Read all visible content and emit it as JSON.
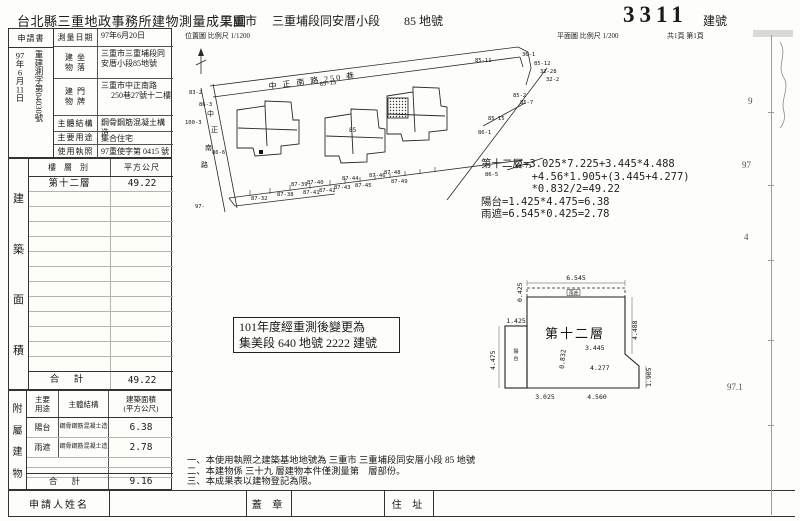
{
  "header": {
    "office_title": "台北縣三重地政事務所建物測量成果圖",
    "city": "三重市",
    "section": "三重埔段同安厝小段",
    "land_no": "85 地號",
    "building_no": "3311",
    "building_no_label": "建號",
    "location_map_caption": "位置圖 比例尺 1/1200",
    "floor_plan_caption": "平面圖 比例尺 1/200",
    "page_info": "共1頁 第1頁"
  },
  "info": {
    "application_label": "申請書",
    "file_date": "97年6月11日",
    "file_no_prefix": "重建測字第",
    "file_no_number": "04030",
    "file_no_suffix": "號",
    "rows": [
      {
        "label1": "測量日期",
        "label2": "",
        "value": "97年6月20日",
        "value2": ""
      },
      {
        "label1": "建 坐",
        "label2": "物 落",
        "value": "三重市三重埔段同安厝小段85地號",
        "value2": ""
      },
      {
        "label1": "建 門",
        "label2": "物 牌",
        "value": "三重市中正南路",
        "value2": "250巷27號十二樓"
      },
      {
        "label1": "主體結構",
        "label2": "",
        "value": "鋼骨鋼筋混凝土構造",
        "value2": ""
      },
      {
        "label1": "主要用途",
        "label2": "",
        "value": "集合住宅",
        "value2": ""
      },
      {
        "label1": "使用執照",
        "label2": "",
        "value": "97重使字第 0415 號",
        "value2": ""
      }
    ]
  },
  "area_table": {
    "side_chars": [
      "建",
      "築",
      "面",
      "積"
    ],
    "col_floor": "樓 層 別",
    "col_area": "平方公尺",
    "rows": [
      {
        "floor": "第十二層",
        "area": "49.22"
      }
    ],
    "empty_row_count": 12,
    "total_label": "合 計",
    "total_value": "49.22"
  },
  "annex_table": {
    "side_chars": [
      "附",
      "屬",
      "建",
      "物"
    ],
    "head_use_1": "主要",
    "head_use_2": "用途",
    "head_structure": "主體結構",
    "head_area_1": "建築面積",
    "head_area_2": "(平方公尺)",
    "rows": [
      {
        "use": "陽台",
        "structure": "鋼骨鋼筋混凝土造",
        "area": "6.38"
      },
      {
        "use": "雨遮",
        "structure": "鋼骨鋼筋混凝土造",
        "area": "2.78"
      }
    ],
    "total_label": "合 計",
    "total_value": "9.16"
  },
  "applicant_row": {
    "name_label": "申請人姓名",
    "seal_label": "蓋 章",
    "address_label": "住 址"
  },
  "stamp": {
    "line1": "101年度經重測後變更為",
    "line2": "集美段 640 地號 2222 建號"
  },
  "calc": {
    "lines": [
      "第十二層=3.025*7.225+3.445*4.488",
      "        +4.56*1.905+(3.445+4.277)",
      "        *0.832/2=49.22",
      "陽台=1.425*4.475=6.38",
      "雨遮=6.545*0.425=2.78"
    ]
  },
  "site_plan": {
    "street_top": "中 正 南 路 250 巷",
    "street_left_chars": [
      "中",
      "正",
      "南",
      "路"
    ],
    "parcel_label": "85",
    "lot_labels": [
      "83-2",
      "86-3",
      "100-3",
      "86-6",
      "97-",
      "85-13",
      "36-1",
      "85-12",
      "32-28",
      "32-2",
      "85-11",
      "85-2",
      "85-7",
      "85-15",
      "86-1",
      "87-32",
      "87-38",
      "87-39",
      "87-40",
      "87-41",
      "87-42",
      "87-43",
      "87-44",
      "87-45",
      "87-46",
      "87-48",
      "87-49",
      "86-5",
      "87-73"
    ]
  },
  "floor_plan": {
    "room_label": "第十二層",
    "balcony_chars": [
      "陽",
      "台"
    ],
    "eave_label": "雨遮",
    "dim_top": "6.545",
    "dim_eave_depth": "0.425",
    "dim_balcony_w": "1.425",
    "dim_balcony_h": "4.475",
    "dim_right_upper": "4.488",
    "dim_right_lower": "1.905",
    "dim_bottom_left": "3.025",
    "dim_bottom_right": "4.560",
    "dim_inner_a": "3.445",
    "dim_inner_b": "0.832",
    "dim_inner_c": "4.277"
  },
  "notes": [
    "一、本使用執照之建築基地地號為 三重市 三重埔段同安厝小段 85  地號",
    "二、本建物係 三十九 層建物本件僅測量第　層部份。",
    "三、本成果表以建物登記為限。"
  ],
  "edge_marks": [
    "9",
    "97",
    "4",
    "97.1"
  ]
}
